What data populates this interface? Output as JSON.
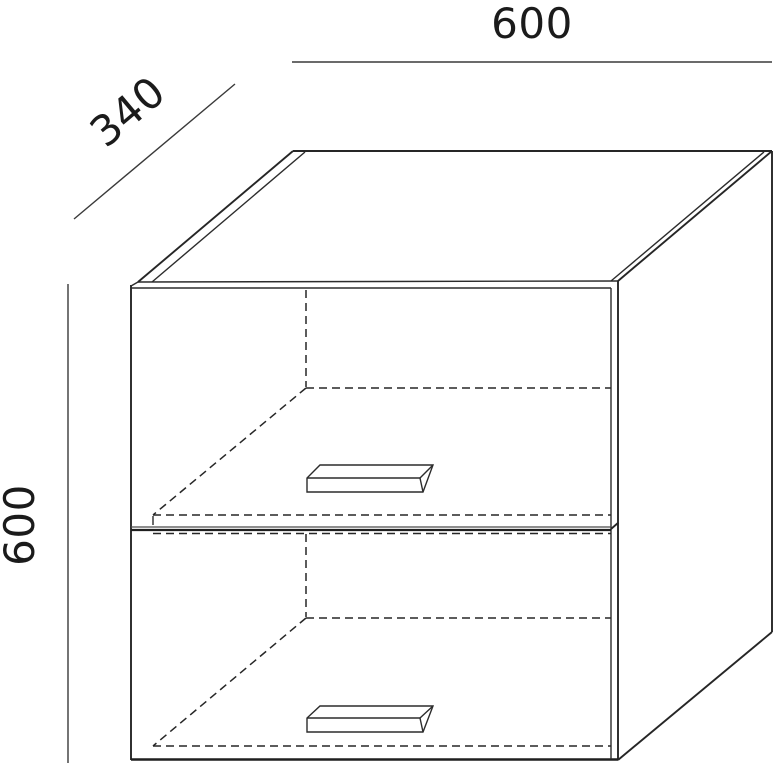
{
  "drawing": {
    "type": "furniture-dimension-diagram",
    "object": "two-door flip-up wall cabinet, isometric line drawing with hidden interior lines",
    "labels": {
      "width": "600",
      "depth": "340",
      "height": "600"
    },
    "colors": {
      "background": "#ffffff",
      "line": "#2c2c2c",
      "text": "#1b1b1b"
    }
  }
}
